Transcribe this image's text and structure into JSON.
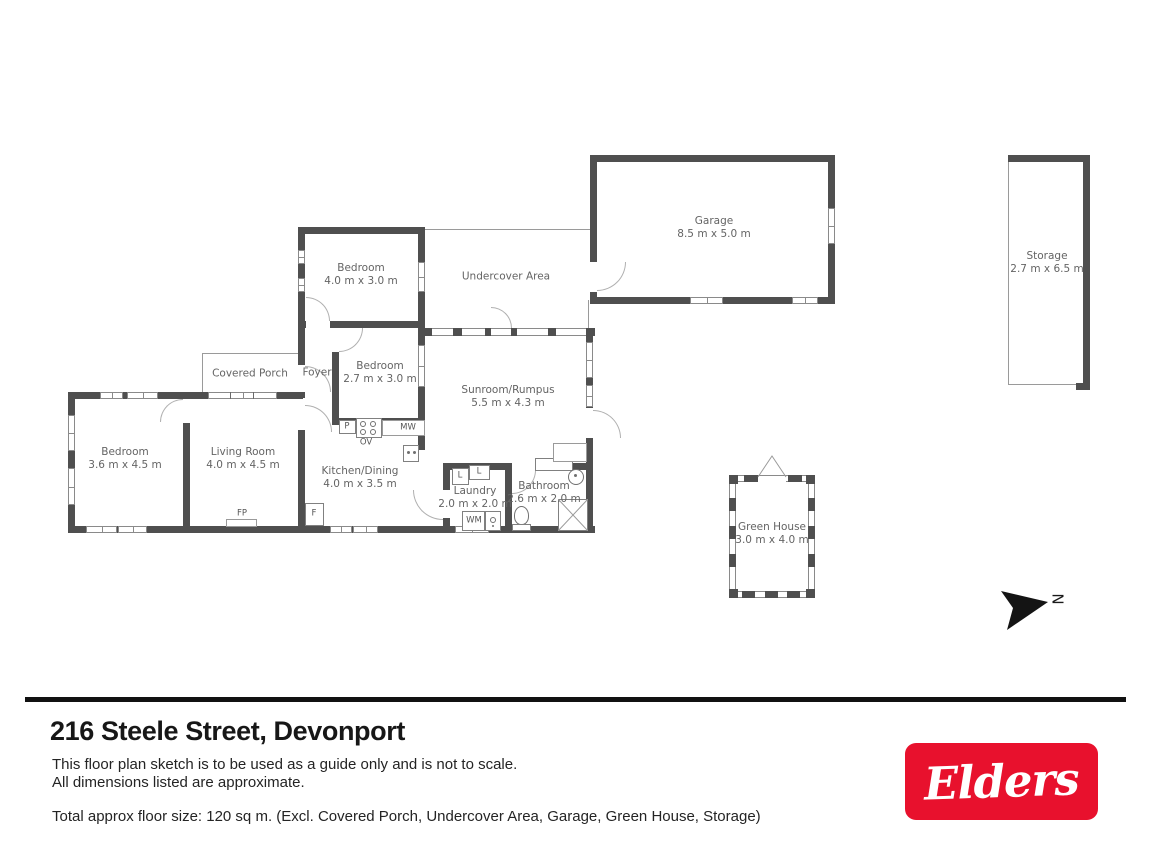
{
  "floorplan": {
    "rooms": [
      {
        "id": "bedroom-top",
        "name": "Bedroom",
        "dims": "4.0 m x 3.0 m"
      },
      {
        "id": "undercover",
        "name": "Undercover Area",
        "dims": ""
      },
      {
        "id": "garage",
        "name": "Garage",
        "dims": "8.5 m x 5.0 m"
      },
      {
        "id": "storage",
        "name": "Storage",
        "dims": "2.7 m x 6.5 m"
      },
      {
        "id": "covered-porch",
        "name": "Covered Porch",
        "dims": ""
      },
      {
        "id": "foyer",
        "name": "Foyer",
        "dims": ""
      },
      {
        "id": "bedroom-mid",
        "name": "Bedroom",
        "dims": "2.7 m x 3.0 m"
      },
      {
        "id": "sunroom",
        "name": "Sunroom/Rumpus",
        "dims": "5.5 m x 4.3 m"
      },
      {
        "id": "bedroom-left",
        "name": "Bedroom",
        "dims": "3.6 m x 4.5 m"
      },
      {
        "id": "living-room",
        "name": "Living Room",
        "dims": "4.0 m x 4.5 m"
      },
      {
        "id": "kitchen",
        "name": "Kitchen/Dining",
        "dims": "4.0 m x 3.5 m"
      },
      {
        "id": "laundry",
        "name": "Laundry",
        "dims": "2.0 m x 2.0 m"
      },
      {
        "id": "bathroom",
        "name": "Bathroom",
        "dims": "2.6 m x 2.0 m"
      },
      {
        "id": "green-house",
        "name": "Green House",
        "dims": "3.0 m x 4.0 m"
      }
    ],
    "fixtures": {
      "fp": "FP",
      "f": "F",
      "p": "P",
      "ov": "OV",
      "mw": "MW",
      "wm": "WM",
      "l1": "L",
      "l2": "L"
    },
    "compass": {
      "label": "N"
    }
  },
  "footer": {
    "address": "216 Steele Street, Devonport",
    "disclaimer": [
      "This floor plan sketch is to be used as a guide only and is not to scale.",
      "All dimensions listed are approximate."
    ],
    "floor_size": "Total approx floor size: 120 sq m. (Excl. Covered Porch, Undercover Area, Garage, Green House, Storage)",
    "logo_text": "Elders"
  },
  "colors": {
    "wall": "#4f4f4f",
    "logo_red": "#e8112d"
  }
}
